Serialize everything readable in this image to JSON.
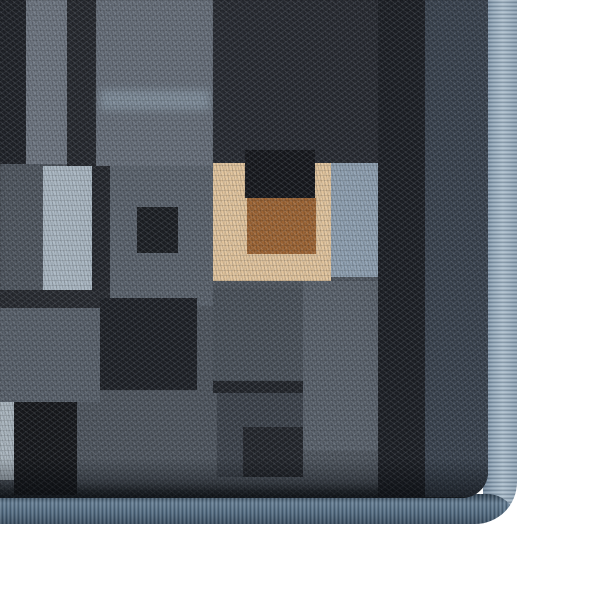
{
  "scene": {
    "subject": "area-rug-corner-photo",
    "background_color": "#ffffff",
    "rug": {
      "outer_width": 517,
      "outer_height": 524,
      "corner_radius": 42,
      "pile_width": 488,
      "pile_height": 498
    }
  },
  "palette": {
    "photo_bg": "#ffffff",
    "pile_base": "#4f565f",
    "fringe_dark": "#6b8095",
    "fringe_mid": "#90a5b7",
    "fringe_light": "#a8bac9",
    "fringe_mid2": "#8ba0b2",
    "binding_edge": "#2b3c4c",
    "binding_hi": "#647d93",
    "binding_mid": "#50697f",
    "binding_low": "#3a4d60",
    "accent_beige": "#e2c59e",
    "accent_brown": "#9d6535",
    "accent_light_blue": "#aab7c2",
    "dark_navy": "#1d2026"
  },
  "rug": {
    "blocks": [
      {
        "name": "column-black-left",
        "x": 0,
        "y": 0,
        "w": 26,
        "h": 164,
        "color": "#202329"
      },
      {
        "name": "column-gray-left",
        "x": 26,
        "y": 0,
        "w": 41,
        "h": 164,
        "color": "#6d7580"
      },
      {
        "name": "column-dark-second",
        "x": 67,
        "y": 0,
        "w": 29,
        "h": 166,
        "color": "#26292f"
      },
      {
        "name": "block-gray-streaked",
        "x": 96,
        "y": 0,
        "w": 117,
        "h": 166,
        "color": "#666e79"
      },
      {
        "name": "streak-light",
        "x": 100,
        "y": 90,
        "w": 110,
        "h": 20,
        "color": "#93a5b4",
        "opacity": 0.55,
        "blur": 4
      },
      {
        "name": "field-dark-top",
        "x": 213,
        "y": 0,
        "w": 212,
        "h": 164,
        "color": "#282b32"
      },
      {
        "name": "band-dark-vertical",
        "x": 378,
        "y": 0,
        "w": 47,
        "h": 497,
        "color": "#1d2026"
      },
      {
        "name": "column-navy-border",
        "x": 425,
        "y": 0,
        "w": 63,
        "h": 497,
        "color": "#3a434f"
      },
      {
        "name": "rect-light-blue-left",
        "x": 43,
        "y": 166,
        "w": 49,
        "h": 124,
        "color": "#aab7c2"
      },
      {
        "name": "strip-dark-left",
        "x": 92,
        "y": 166,
        "w": 18,
        "h": 124,
        "color": "#25282e"
      },
      {
        "name": "block-gray-middle",
        "x": 110,
        "y": 166,
        "w": 103,
        "h": 140,
        "color": "#5b636d"
      },
      {
        "name": "square-dark-inner",
        "x": 137,
        "y": 207,
        "w": 41,
        "h": 46,
        "color": "#1d2025"
      },
      {
        "name": "square-beige",
        "x": 213,
        "y": 163,
        "w": 118,
        "h": 118,
        "color": "#e2c59e"
      },
      {
        "name": "notch-black",
        "x": 245,
        "y": 150,
        "w": 70,
        "h": 48,
        "color": "#17191e"
      },
      {
        "name": "square-brown",
        "x": 247,
        "y": 198,
        "w": 69,
        "h": 56,
        "color": "#9d6535"
      },
      {
        "name": "square-light-blue-right",
        "x": 331,
        "y": 163,
        "w": 47,
        "h": 114,
        "color": "#8fa0b1"
      },
      {
        "name": "band-dark-horizontal-left",
        "x": 0,
        "y": 290,
        "w": 110,
        "h": 18,
        "color": "#282b31"
      },
      {
        "name": "field-gray-left-lower",
        "x": 0,
        "y": 308,
        "w": 100,
        "h": 94,
        "color": "#59616b"
      },
      {
        "name": "block-dark-mid-left",
        "x": 100,
        "y": 298,
        "w": 97,
        "h": 92,
        "color": "#1f2228"
      },
      {
        "name": "square-gray-outlined",
        "x": 213,
        "y": 288,
        "w": 104,
        "h": 93,
        "color": "#4a515a"
      },
      {
        "name": "edge-dark-under-square",
        "x": 213,
        "y": 381,
        "w": 104,
        "h": 12,
        "color": "#23262c"
      },
      {
        "name": "column-gray-right-lower",
        "x": 303,
        "y": 281,
        "w": 75,
        "h": 170,
        "color": "#5a626c"
      },
      {
        "name": "block-gray-low-center",
        "x": 217,
        "y": 393,
        "w": 86,
        "h": 84,
        "color": "#3d434c"
      },
      {
        "name": "square-dark-low-center",
        "x": 243,
        "y": 427,
        "w": 60,
        "h": 50,
        "color": "#24272d"
      },
      {
        "name": "sliver-light-bottom-left",
        "x": 0,
        "y": 402,
        "w": 14,
        "h": 78,
        "color": "#a9b4bd"
      },
      {
        "name": "block-black-bottom-left",
        "x": 14,
        "y": 402,
        "w": 63,
        "h": 93,
        "color": "#17191d"
      }
    ]
  }
}
